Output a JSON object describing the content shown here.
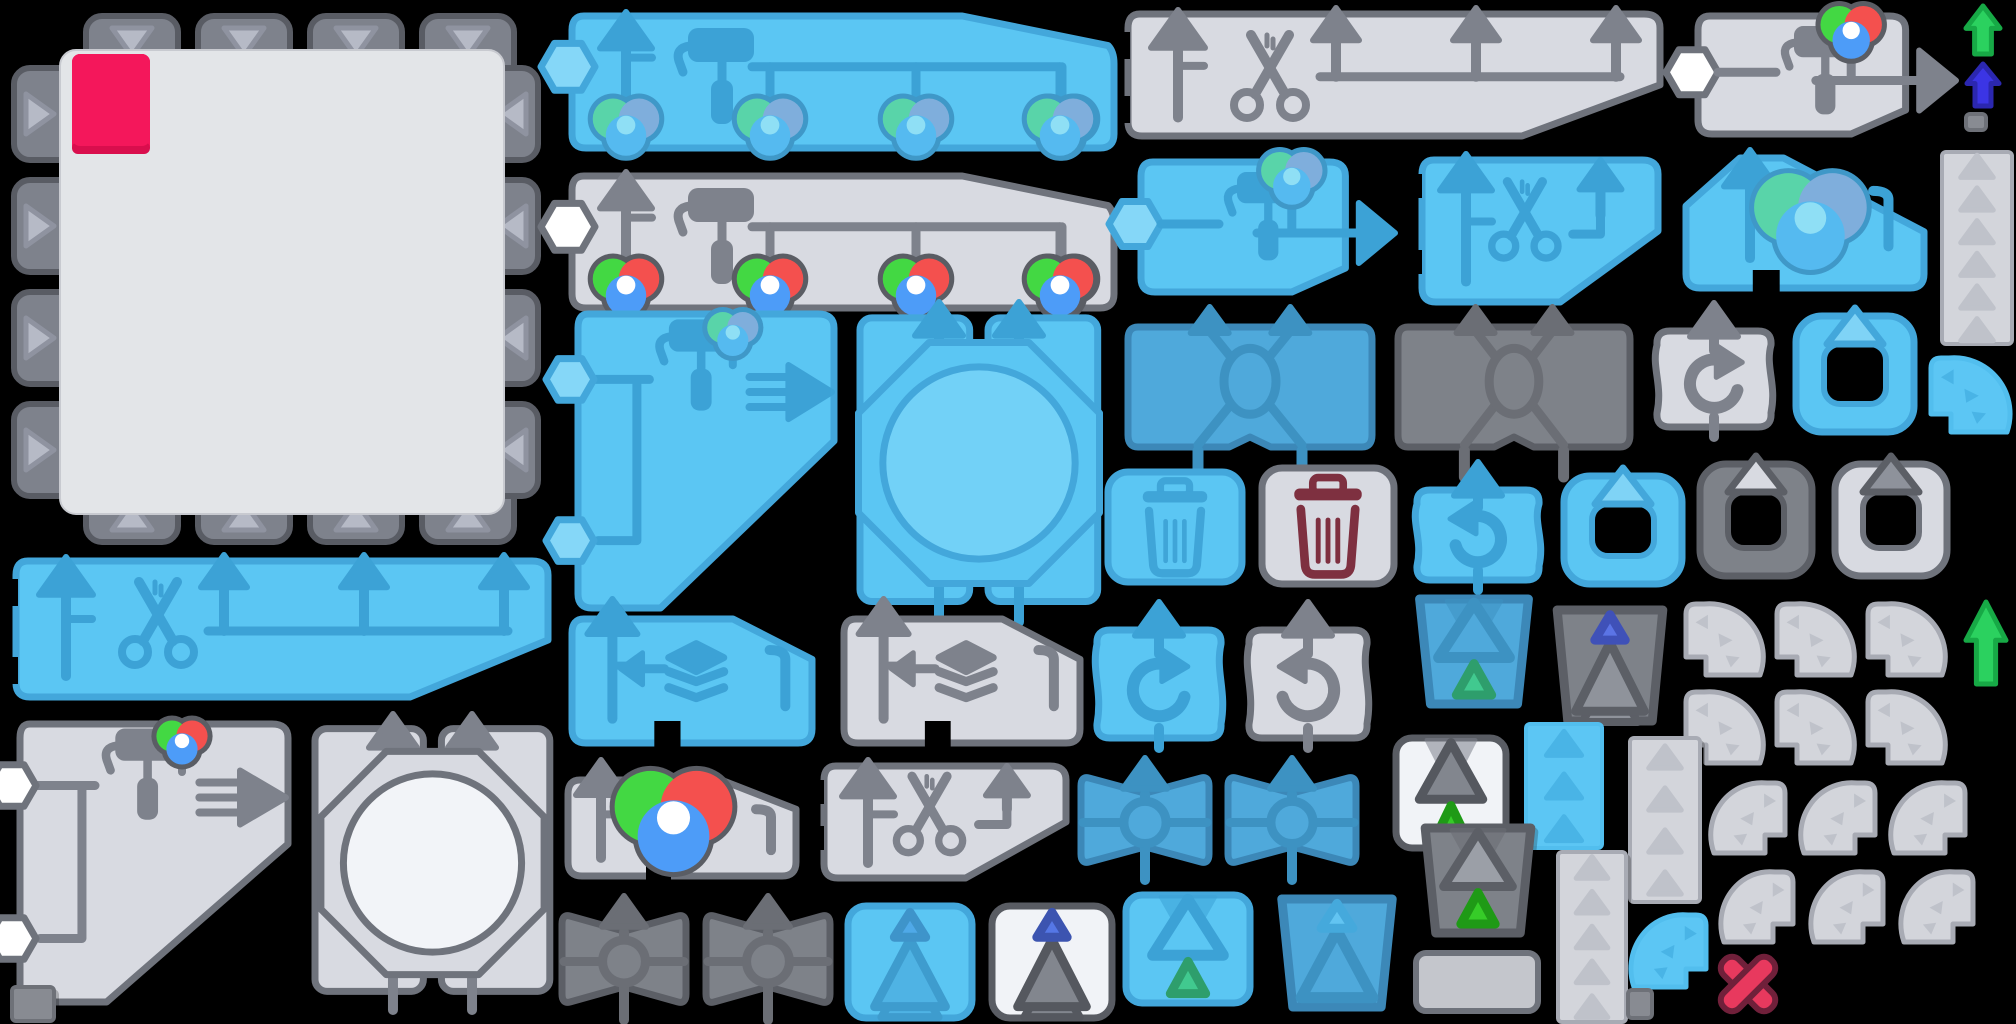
{
  "meta": {
    "canvas_width": 2016,
    "canvas_height": 1024,
    "background": "#000000"
  },
  "colors": {
    "palettes": {
      "blue": {
        "fill": "#5BC6F3",
        "stroke": "#43A7DB",
        "icon": "#3CA2D6",
        "light": "#85D7F8",
        "inner": "#72D1F7"
      },
      "midblue": {
        "fill": "#4FA9DB",
        "stroke": "#3C88B8",
        "icon": "#3D92C2",
        "light": "#6FC3EC",
        "inner": "#65BEE9"
      },
      "gray": {
        "fill": "#D8DAE1",
        "stroke": "#6F737C",
        "icon": "#7E828C",
        "light": "#EDEFF3",
        "inner": "#F2F4F8"
      },
      "darkgray": {
        "fill": "#7E8289",
        "stroke": "#5C5F66",
        "icon": "#6B6E75",
        "light": "#A6AAB2",
        "inner": "#95999F"
      },
      "white": {
        "fill": "#F1F3F7",
        "stroke": "#595C63",
        "icon": "#7E828C",
        "light": "#FFFFFF",
        "inner": "#FFFFFF"
      },
      "faint": {
        "fill": "#D3D5DB",
        "stroke": "#A8ABB4",
        "icon": "#BFC2CA",
        "light": "#E2E4E9",
        "inner": "#E9EBEF"
      },
      "bluefaint": {
        "fill": "#5CC6F4",
        "stroke": "#52BEEE",
        "icon": "#49B4E6",
        "light": "#8ED9F8",
        "inner": "#72D1F7"
      }
    },
    "tile": {
      "fill": "#E3E5E8",
      "tab": "#7E828C",
      "tab_stroke": "#595C64",
      "tri": "#B6BAC6",
      "tri_stroke": "#8F93A0",
      "swatch": "#F4175B",
      "swatch_lip": "#D90E4D"
    },
    "accents": {
      "pink": "#F4175B",
      "maroon": "#7E3040",
      "green": "#2BD15F",
      "green_border": "#17A946",
      "indigo": "#3B35E5",
      "indigo_border": "#2B27B0",
      "red_x": "#E8395E",
      "red_x_border": "#70203A"
    },
    "ball_sets": {
      "rgb": {
        "cols": [
          "#43D843",
          "#F4504E",
          "#4D9CF8"
        ],
        "border": "#5A5D64",
        "center": "#FFFFFF"
      },
      "muted": {
        "cols": [
          "#59D4A9",
          "#7FAEDC",
          "#55BAF0"
        ],
        "border": "#3F98C8",
        "center": "#8FDFF5"
      }
    }
  },
  "sprites": [
    {
      "name": "canvas-socket-tile",
      "kind": "tile",
      "x": 8,
      "y": 8,
      "w": 536,
      "h": 540
    },
    {
      "name": "spray-all-bar-blue",
      "kind": "sprayBar",
      "x": 562,
      "y": 6,
      "w": 556,
      "h": 152,
      "pal": "blue",
      "opts": {
        "hex": "blue",
        "balls": "muted"
      }
    },
    {
      "name": "spray-all-bar-gray",
      "kind": "sprayBar",
      "x": 562,
      "y": 166,
      "w": 556,
      "h": 152,
      "pal": "gray",
      "opts": {
        "hex": "white",
        "balls": "rgb"
      }
    },
    {
      "name": "cut-all-bar-gray",
      "kind": "cutBar",
      "x": 1120,
      "y": 6,
      "w": 548,
      "h": 136,
      "pal": "gray"
    },
    {
      "name": "cut-all-bar-blue",
      "kind": "cutBar",
      "x": 8,
      "y": 553,
      "w": 548,
      "h": 150,
      "pal": "blue"
    },
    {
      "name": "paint-output-wide-gray",
      "kind": "paintArrow",
      "x": 1688,
      "y": 6,
      "w": 272,
      "h": 138,
      "pal": "gray",
      "opts": {
        "hex": "white",
        "balls": "rgb"
      }
    },
    {
      "name": "paint-output-blue",
      "kind": "paintArrow",
      "x": 1131,
      "y": 152,
      "w": 268,
      "h": 150,
      "pal": "blue",
      "opts": {
        "hex": "blue",
        "balls": "muted"
      }
    },
    {
      "name": "upgrade-arrow-green-top",
      "kind": "bigArrow",
      "x": 1962,
      "y": 2,
      "w": 42,
      "h": 56,
      "opts": {
        "color": "#2BD15F",
        "border": "#17A946"
      }
    },
    {
      "name": "upgrade-arrow-indigo",
      "kind": "bigArrow",
      "x": 1963,
      "y": 60,
      "w": 40,
      "h": 50,
      "opts": {
        "color": "#3B35E5",
        "border": "#2B27B0"
      }
    },
    {
      "name": "pixel-square-a",
      "kind": "square",
      "x": 1964,
      "y": 112,
      "w": 24,
      "h": 20
    },
    {
      "name": "tri-column-right",
      "kind": "column",
      "x": 1940,
      "y": 150,
      "w": 74,
      "h": 196,
      "pal": "faint",
      "opts": {
        "n": 6
      }
    },
    {
      "name": "fan-blue-top",
      "kind": "fan",
      "x": 1923,
      "y": 350,
      "w": 90,
      "h": 88,
      "pal": "bluefaint",
      "opts": {
        "dir": "ne"
      }
    },
    {
      "name": "cut-shape-blue",
      "kind": "cutShape",
      "x": 1414,
      "y": 152,
      "w": 252,
      "h": 158,
      "pal": "blue"
    },
    {
      "name": "ball-shape-blue",
      "kind": "ballShape",
      "x": 1676,
      "y": 150,
      "w": 256,
      "h": 146,
      "pal": "blue",
      "opts": {
        "balls": "muted"
      }
    },
    {
      "name": "diag-paint-blue",
      "kind": "diagPaint",
      "x": 566,
      "y": 302,
      "w": 278,
      "h": 316,
      "pal": "blue",
      "opts": {
        "hex": "blue",
        "balls": "muted"
      }
    },
    {
      "name": "octagon-press-blue",
      "kind": "octagon",
      "x": 850,
      "y": 300,
      "w": 258,
      "h": 326,
      "pal": "blue"
    },
    {
      "name": "cross-swap-blue",
      "kind": "xShape",
      "x": 1120,
      "y": 303,
      "w": 260,
      "h": 178,
      "pal": "midblue"
    },
    {
      "name": "cross-swap-dark",
      "kind": "xShape",
      "x": 1390,
      "y": 303,
      "w": 248,
      "h": 178,
      "pal": "darkgray"
    },
    {
      "name": "redo-shape-gray",
      "kind": "cShape",
      "x": 1648,
      "y": 301,
      "w": 132,
      "h": 138,
      "pal": "gray",
      "opts": {
        "dir": "cw"
      }
    },
    {
      "name": "frame-blue-a",
      "kind": "frame",
      "x": 1788,
      "y": 300,
      "w": 134,
      "h": 140,
      "pal": "blue",
      "opts": {
        "tri": "#7FD3F6",
        "tri_border": "#43A7DB"
      }
    },
    {
      "name": "trash-blue",
      "kind": "trash",
      "x": 1100,
      "y": 462,
      "w": 150,
      "h": 130,
      "pal": "blue",
      "opts": {
        "icon": "#3FA5D8"
      }
    },
    {
      "name": "trash-maroon",
      "kind": "trash",
      "x": 1254,
      "y": 458,
      "w": 148,
      "h": 136,
      "pal": "gray",
      "opts": {
        "icon": "#7E3040"
      }
    },
    {
      "name": "undo-shape-blue",
      "kind": "cShape",
      "x": 1408,
      "y": 460,
      "w": 140,
      "h": 132,
      "pal": "blue",
      "opts": {
        "dir": "ccw"
      }
    },
    {
      "name": "frame-blue-b",
      "kind": "frame",
      "x": 1556,
      "y": 460,
      "w": 134,
      "h": 132,
      "pal": "blue",
      "opts": {
        "tri": "#7FD3F6",
        "tri_border": "#43A7DB"
      }
    },
    {
      "name": "frame-dark",
      "kind": "frame",
      "x": 1692,
      "y": 448,
      "w": 128,
      "h": 136,
      "pal": "darkgray",
      "opts": {
        "tri": "#D8DAE1",
        "tri_border": "#5C5F66"
      }
    },
    {
      "name": "frame-light",
      "kind": "frame",
      "x": 1827,
      "y": 448,
      "w": 128,
      "h": 136,
      "pal": "gray",
      "opts": {
        "tri": "#8E929B",
        "tri_border": "#5C5F66"
      }
    },
    {
      "name": "layers-pick-blue",
      "kind": "layers",
      "x": 560,
      "y": 597,
      "w": 262,
      "h": 156,
      "pal": "blue"
    },
    {
      "name": "layers-pick-gray",
      "kind": "layers",
      "x": 832,
      "y": 597,
      "w": 258,
      "h": 156,
      "pal": "gray"
    },
    {
      "name": "redo-curvy-blue",
      "kind": "cShape",
      "x": 1088,
      "y": 600,
      "w": 142,
      "h": 150,
      "pal": "blue",
      "opts": {
        "dir": "cw"
      }
    },
    {
      "name": "undo-curvy-gray",
      "kind": "cShape",
      "x": 1240,
      "y": 600,
      "w": 136,
      "h": 150,
      "pal": "gray",
      "opts": {
        "dir": "ccw"
      }
    },
    {
      "name": "bucket-blue",
      "kind": "triCard",
      "x": 1406,
      "y": 591,
      "w": 136,
      "h": 121,
      "pal": "midblue",
      "opts": {
        "shape": "trap",
        "notch": true,
        "big": {
          "outline": true,
          "pos": "top"
        },
        "small": {
          "color": "#41C98F",
          "border": "#2E9E6C",
          "pos": "bottom"
        }
      }
    },
    {
      "name": "trapezoid-dark-indigo",
      "kind": "triCard",
      "x": 1544,
      "y": 602,
      "w": 132,
      "h": 127,
      "pal": "darkgray",
      "opts": {
        "shape": "trap",
        "small": {
          "color": "#5B74E6",
          "border": "#3F51B8",
          "pos": "top"
        },
        "big": {
          "color": "#8F939B",
          "border": "#5C5F66",
          "pos": "bottom"
        }
      }
    },
    {
      "name": "fan-1",
      "kind": "fan",
      "x": 1678,
      "y": 596,
      "w": 88,
      "h": 85,
      "pal": "faint",
      "opts": {
        "dir": "ne"
      }
    },
    {
      "name": "fan-2",
      "kind": "fan",
      "x": 1769,
      "y": 596,
      "w": 88,
      "h": 85,
      "pal": "faint",
      "opts": {
        "dir": "ne"
      }
    },
    {
      "name": "fan-3",
      "kind": "fan",
      "x": 1860,
      "y": 596,
      "w": 88,
      "h": 85,
      "pal": "faint",
      "opts": {
        "dir": "ne"
      }
    },
    {
      "name": "fan-4",
      "kind": "fan",
      "x": 1678,
      "y": 684,
      "w": 88,
      "h": 85,
      "pal": "faint",
      "opts": {
        "dir": "ne"
      }
    },
    {
      "name": "fan-5",
      "kind": "fan",
      "x": 1769,
      "y": 684,
      "w": 88,
      "h": 85,
      "pal": "faint",
      "opts": {
        "dir": "ne"
      }
    },
    {
      "name": "fan-6",
      "kind": "fan",
      "x": 1860,
      "y": 684,
      "w": 88,
      "h": 85,
      "pal": "faint",
      "opts": {
        "dir": "ne"
      }
    },
    {
      "name": "upgrade-arrow-green-bottom",
      "kind": "bigArrow",
      "x": 1962,
      "y": 598,
      "w": 48,
      "h": 90,
      "opts": {
        "color": "#2BD15F",
        "border": "#17A946"
      }
    },
    {
      "name": "colorwheel-gray",
      "kind": "colorwheel",
      "x": 556,
      "y": 758,
      "w": 250,
      "h": 128,
      "pal": "gray"
    },
    {
      "name": "scissors-diag-gray",
      "kind": "cutShape",
      "x": 816,
      "y": 758,
      "w": 258,
      "h": 128,
      "pal": "gray"
    },
    {
      "name": "bowtie-blue-a",
      "kind": "bowtie",
      "x": 1075,
      "y": 758,
      "w": 140,
      "h": 124,
      "pal": "midblue"
    },
    {
      "name": "bowtie-blue-b",
      "kind": "bowtie",
      "x": 1222,
      "y": 758,
      "w": 140,
      "h": 124,
      "pal": "midblue"
    },
    {
      "name": "card-white-green",
      "kind": "triCard",
      "x": 1390,
      "y": 730,
      "w": 122,
      "h": 126,
      "pal": "white",
      "opts": {
        "shape": "rect",
        "notch": true,
        "big": {
          "color": "#82868E",
          "border": "#55585F",
          "pos": "top"
        },
        "small": {
          "color": "#36CC28",
          "border": "#1F9A16",
          "pos": "bottom"
        }
      }
    },
    {
      "name": "blue-rect-tris",
      "kind": "column",
      "x": 1524,
      "y": 722,
      "w": 80,
      "h": 128,
      "pal": "bluefaint",
      "opts": {
        "n": 3
      }
    },
    {
      "name": "tri-column-a",
      "kind": "column",
      "x": 1628,
      "y": 736,
      "w": 74,
      "h": 168,
      "pal": "faint",
      "opts": {
        "n": 4
      }
    },
    {
      "name": "tri-column-b",
      "kind": "column",
      "x": 1556,
      "y": 850,
      "w": 72,
      "h": 174,
      "pal": "faint",
      "opts": {
        "n": 5
      }
    },
    {
      "name": "fan-7",
      "kind": "fan",
      "x": 1708,
      "y": 775,
      "w": 85,
      "h": 84,
      "pal": "faint",
      "opts": {
        "dir": "nw"
      }
    },
    {
      "name": "fan-8",
      "kind": "fan",
      "x": 1798,
      "y": 775,
      "w": 85,
      "h": 84,
      "pal": "faint",
      "opts": {
        "dir": "nw"
      }
    },
    {
      "name": "fan-9",
      "kind": "fan",
      "x": 1888,
      "y": 775,
      "w": 85,
      "h": 84,
      "pal": "faint",
      "opts": {
        "dir": "nw"
      }
    },
    {
      "name": "fan-10",
      "kind": "fan",
      "x": 1718,
      "y": 864,
      "w": 83,
      "h": 84,
      "pal": "faint",
      "opts": {
        "dir": "nw"
      }
    },
    {
      "name": "fan-11",
      "kind": "fan",
      "x": 1808,
      "y": 864,
      "w": 83,
      "h": 84,
      "pal": "faint",
      "opts": {
        "dir": "nw"
      }
    },
    {
      "name": "fan-12",
      "kind": "fan",
      "x": 1898,
      "y": 864,
      "w": 83,
      "h": 84,
      "pal": "faint",
      "opts": {
        "dir": "nw"
      }
    },
    {
      "name": "trapezoid-dark-green",
      "kind": "triCard",
      "x": 1412,
      "y": 820,
      "w": 132,
      "h": 121,
      "pal": "darkgray",
      "opts": {
        "shape": "trap",
        "notch": true,
        "big": {
          "color": "#9B9FA7",
          "border": "#5C5F66",
          "pos": "top"
        },
        "small": {
          "color": "#36CC28",
          "border": "#1F9A16",
          "pos": "bottom"
        }
      }
    },
    {
      "name": "diag-paint-gray",
      "kind": "diagPaint",
      "x": 8,
      "y": 712,
      "w": 290,
      "h": 300,
      "pal": "gray",
      "opts": {
        "hex": "white",
        "balls": "rgb"
      }
    },
    {
      "name": "octagon-press-gray",
      "kind": "octagon",
      "x": 305,
      "y": 712,
      "w": 255,
      "h": 302,
      "pal": "gray"
    },
    {
      "name": "bowtie-dark-a",
      "kind": "bowtie",
      "x": 556,
      "y": 896,
      "w": 136,
      "h": 126,
      "pal": "darkgray"
    },
    {
      "name": "bowtie-dark-b",
      "kind": "bowtie",
      "x": 700,
      "y": 896,
      "w": 136,
      "h": 126,
      "pal": "darkgray"
    },
    {
      "name": "tree-square-blue",
      "kind": "triCard",
      "x": 842,
      "y": 900,
      "w": 136,
      "h": 124,
      "pal": "blue",
      "opts": {
        "shape": "square",
        "small": {
          "color": "#4FA9E8",
          "border": "#3E94CA",
          "pos": "top"
        },
        "big": {
          "color": "#4FB3E4",
          "border": "#3E9CCE",
          "pos": "bottom"
        }
      }
    },
    {
      "name": "tree-square-white",
      "kind": "triCard",
      "x": 986,
      "y": 900,
      "w": 132,
      "h": 124,
      "pal": "white",
      "opts": {
        "shape": "square",
        "small": {
          "color": "#5577E6",
          "border": "#3C54B0",
          "pos": "top"
        },
        "big": {
          "color": "#82868E",
          "border": "#55585F",
          "pos": "bottom"
        }
      }
    },
    {
      "name": "bucket-lightblue",
      "kind": "triCard",
      "x": 1120,
      "y": 887,
      "w": 136,
      "h": 124,
      "pal": "blue",
      "opts": {
        "shape": "rect",
        "notch": true,
        "big": {
          "outline": true,
          "pos": "top"
        },
        "small": {
          "color": "#41C98F",
          "border": "#2E9E6C",
          "pos": "bottom"
        }
      }
    },
    {
      "name": "trapezoid-blue",
      "kind": "triCard",
      "x": 1268,
      "y": 891,
      "w": 138,
      "h": 124,
      "pal": "midblue",
      "opts": {
        "shape": "trap",
        "small": {
          "color": "#62C4F2",
          "border": "#45A9DC",
          "pos": "top"
        },
        "big": {
          "outline": true,
          "pos": "bottom"
        }
      }
    },
    {
      "name": "plain-rect-gray",
      "kind": "plainRect",
      "x": 1412,
      "y": 949,
      "w": 130,
      "h": 66
    },
    {
      "name": "fan-blue-bottom",
      "kind": "fan",
      "x": 1628,
      "y": 907,
      "w": 86,
      "h": 86,
      "pal": "bluefaint",
      "opts": {
        "dir": "nw"
      }
    },
    {
      "name": "pixel-square-b",
      "kind": "square",
      "x": 1626,
      "y": 988,
      "w": 28,
      "h": 32
    },
    {
      "name": "delete-x-mark",
      "kind": "xmark",
      "x": 1717,
      "y": 950,
      "w": 62,
      "h": 68
    },
    {
      "name": "pixel-square-c",
      "kind": "square",
      "x": 10,
      "y": 985,
      "w": 46,
      "h": 38
    }
  ]
}
